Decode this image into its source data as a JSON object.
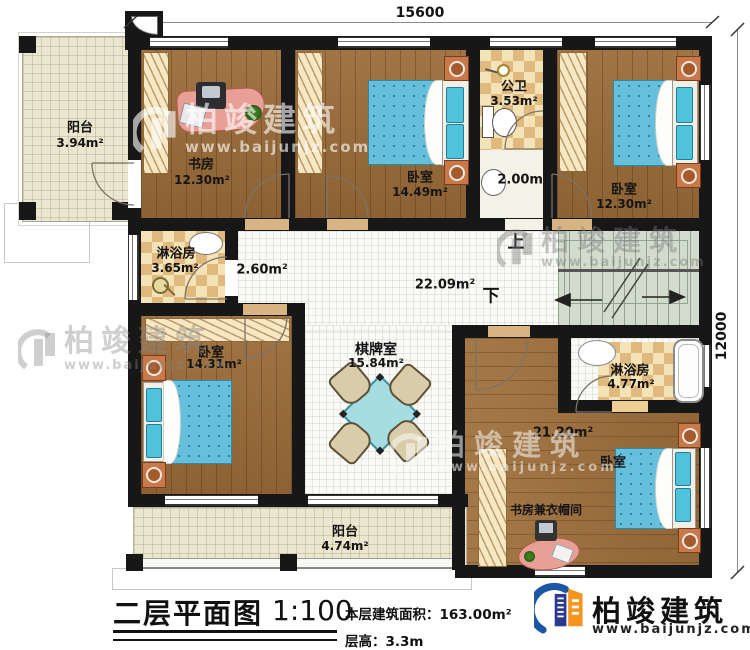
{
  "plan": {
    "dim_top": "15600",
    "dim_right": "12000",
    "stairs_up": "上",
    "stairs_down": "下",
    "rooms": {
      "balcony_top": {
        "name": "阳台",
        "area": "3.94m²"
      },
      "study": {
        "name": "书房",
        "area": "12.30m²"
      },
      "bedroom_top_mid": {
        "name": "卧室",
        "area": "14.49m²"
      },
      "public_bath": {
        "name": "公卫",
        "area": "3.53m²"
      },
      "wash_area": {
        "area": "2.00m²"
      },
      "bedroom_top_right": {
        "name": "卧室",
        "area": "12.30m²"
      },
      "shower_left": {
        "name": "淋浴房",
        "area": "3.65m²"
      },
      "passage": {
        "area": "2.60m²"
      },
      "hall": {
        "area": "22.09m²"
      },
      "bedroom_left": {
        "name": "卧室",
        "area": "14.31m²"
      },
      "chess_room": {
        "name": "棋牌室",
        "area": "15.84m²"
      },
      "shower_right": {
        "name": "淋浴房",
        "area": "4.77m²"
      },
      "bedroom_bottom_right": {
        "name": "卧室",
        "area": "21.20m²"
      },
      "study_cloak": {
        "name": "书房兼衣帽间"
      },
      "balcony_bottom": {
        "name": "阳台",
        "area": "4.74m²"
      }
    }
  },
  "watermark": {
    "brand": "柏竣建筑",
    "url": "www.baijunjz.com"
  },
  "footer": {
    "title": "二层平面图",
    "scale": "1:100",
    "area_label": "本层建筑面积：163.00m²",
    "floor_height_label": "层高：3.3m",
    "brand": "柏竣建筑",
    "brand_url": "www.baijunjz.com"
  },
  "colors": {
    "wall": "#171717",
    "wood": "#9c6d3a",
    "water_blue": "#64c0dc",
    "checker_tan": "#e0b97f",
    "stairs_green": "#d2dccd",
    "brand_blue": "#1c57a5",
    "brand_orange": "#f7941e"
  }
}
